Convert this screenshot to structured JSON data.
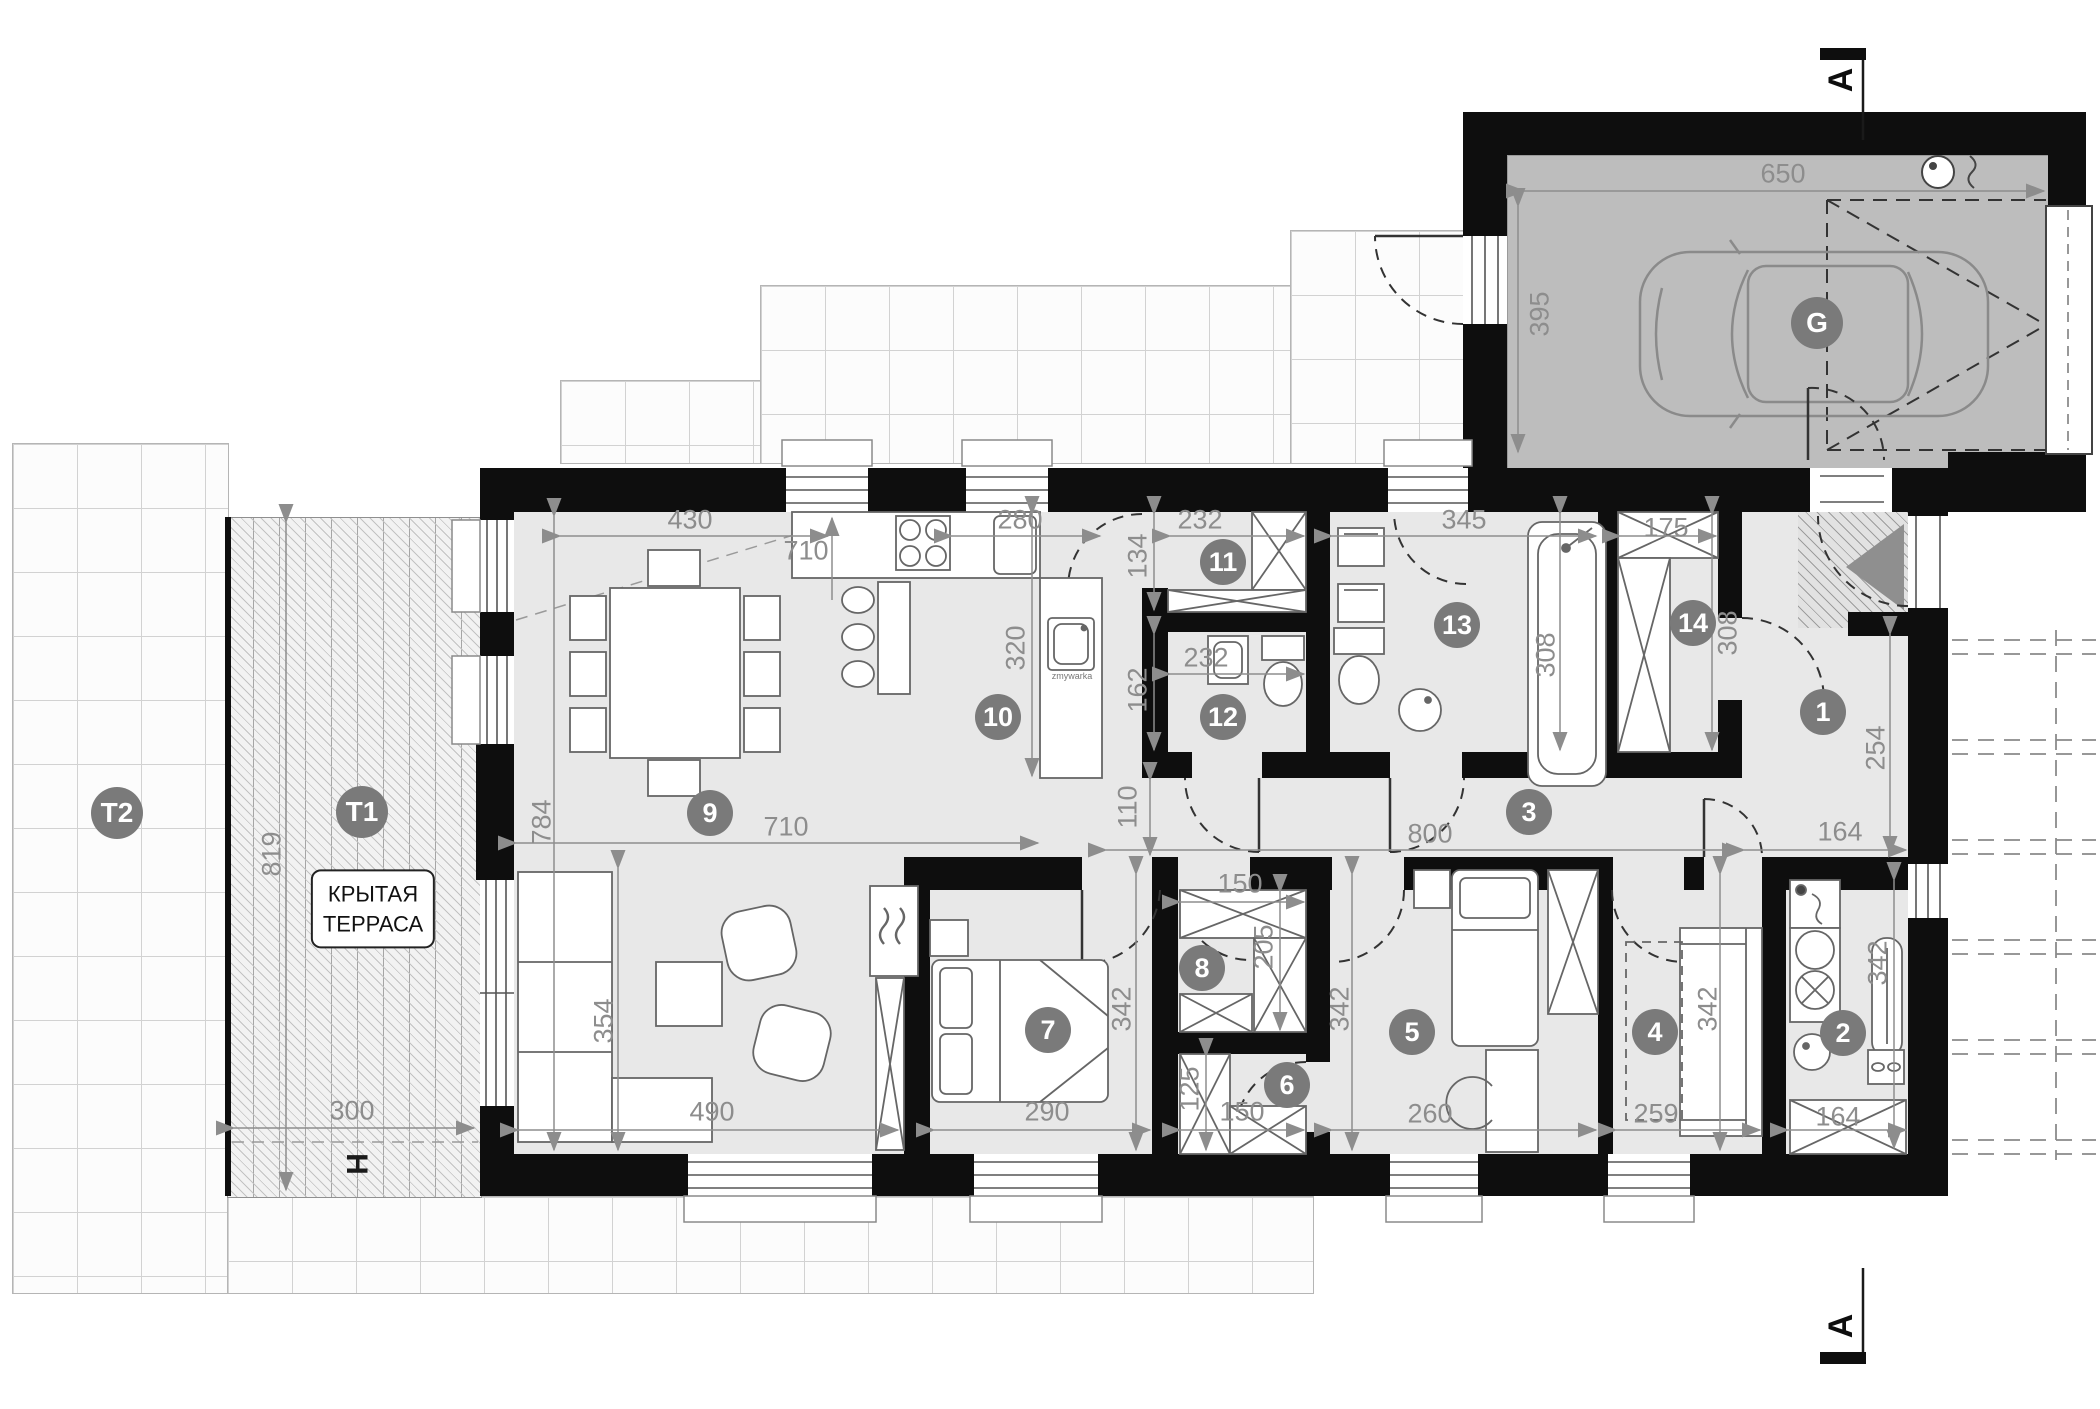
{
  "plan": {
    "covered_terrace": {
      "line1": "КРЫТАЯ",
      "line2": "ТЕРРАСА"
    },
    "labels": {
      "garage": "G",
      "terrace_main": "T1",
      "terrace_side": "T2",
      "column": "H",
      "section": "A",
      "sink_note": "zmywarka"
    },
    "room_numbers": {
      "r1": "1",
      "r2": "2",
      "r3": "3",
      "r4": "4",
      "r5": "5",
      "r6": "6",
      "r7": "7",
      "r8": "8",
      "r9": "9",
      "r10": "10",
      "r11": "11",
      "r12": "12",
      "r13": "13",
      "r14": "14"
    },
    "dimensions_cm": {
      "garage_width": "650",
      "garage_depth": "395",
      "living_top_a": "430",
      "living_top_b": "710",
      "kitchen_window": "280",
      "room11_width": "232",
      "room11_depth": "134",
      "room13_width": "345",
      "room14_width": "175",
      "kitchen_depth": "320",
      "room12_depth": "162",
      "room12_width": "232",
      "room13_depth": "308",
      "room14_depth": "308",
      "hall_depth": "254",
      "hall_width": "164",
      "corridor_width": "110",
      "corridor_length": "800",
      "terrace_depth": "819",
      "living_depth": "784",
      "living_width": "710",
      "lounge_depth": "354",
      "lounge_width": "490",
      "room7_width": "290",
      "room7_depth": "342",
      "room8_width": "150",
      "room8_depth": "205",
      "room6_depth": "125",
      "room6_width": "150",
      "room5_depth": "342",
      "room5_width": "260",
      "room4_depth": "342",
      "room4_width": "259",
      "room2_depth": "342",
      "room2_width": "164",
      "terrace_width": "300"
    }
  }
}
